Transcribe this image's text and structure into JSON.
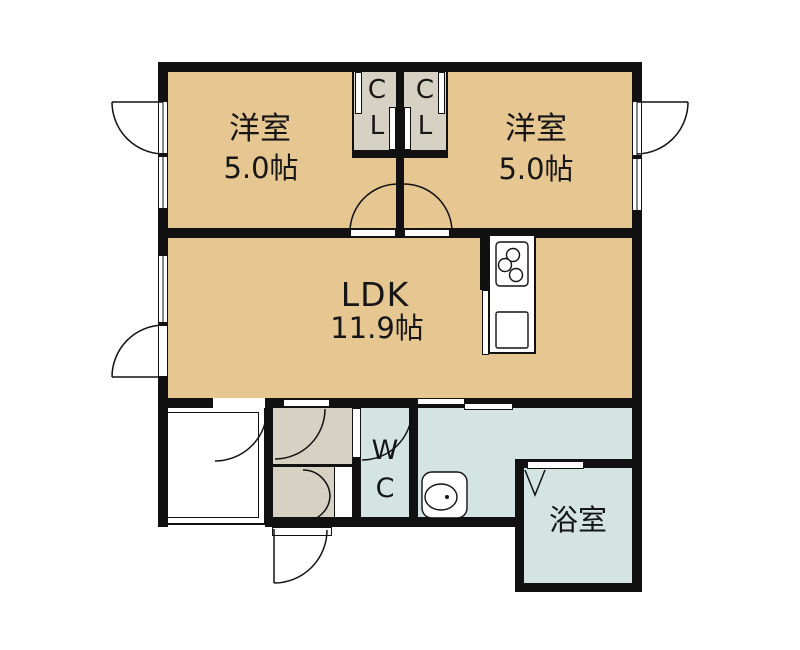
{
  "rooms": {
    "bedroom_left": {
      "name": "洋室",
      "size": "5.0帖"
    },
    "bedroom_right": {
      "name": "洋室",
      "size": "5.0帖"
    },
    "ldk": {
      "name": "LDK",
      "size": "11.9帖"
    },
    "closet_left": {
      "label_top": "C",
      "label_bottom": "L"
    },
    "closet_right": {
      "label_top": "C",
      "label_bottom": "L"
    },
    "toilet": {
      "label_top": "W",
      "label_bottom": "C"
    },
    "bathroom": {
      "name": "浴室"
    }
  },
  "colors": {
    "room_fill": "#e7c791",
    "closet_fill": "#d6d1c3",
    "wet_fill": "#d4e4e3",
    "wall": "#111111",
    "background": "#ffffff"
  }
}
